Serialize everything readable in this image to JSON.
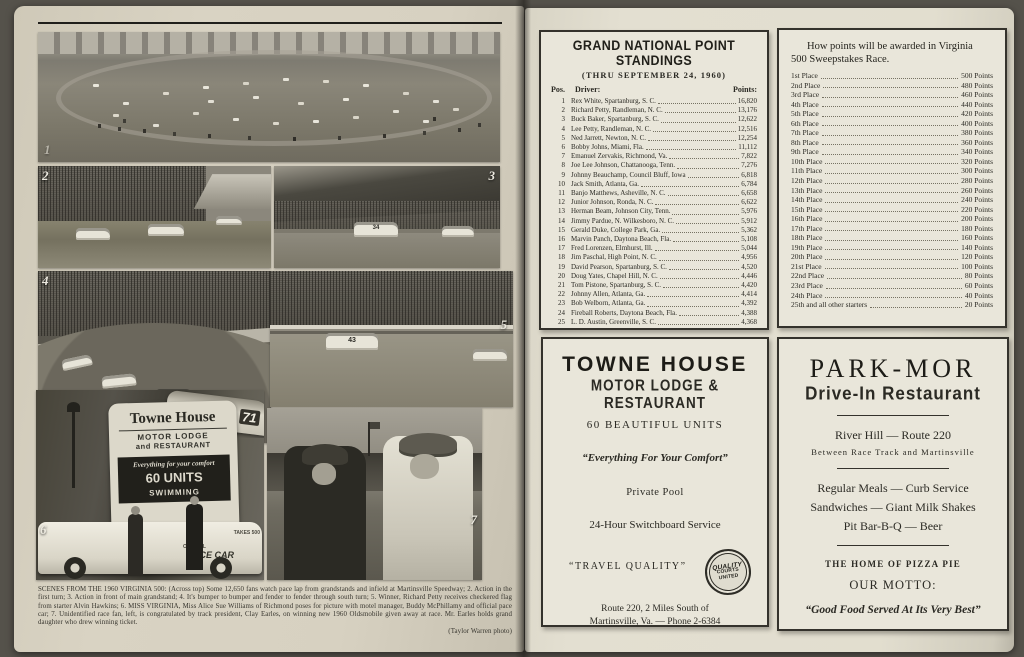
{
  "left": {
    "photo_labels": [
      "1",
      "2",
      "3",
      "4",
      "5",
      "6",
      "7"
    ],
    "photos": {
      "p1_desc": "Some 12,650 fans watch pace lap from grandstands and infield",
      "p2_desc": "Action in the first turn",
      "p3_desc": "Action in front of main grandstand",
      "p4_desc": "Bumper to bumper and fender to fender through south turn",
      "p5_desc": "Winner Richard Petty receives checkered flag",
      "p6_desc": "Miss Virginia with motel manager and official pace car",
      "p7_desc": "Race fan congratulated by track president Clay Earles",
      "p3_car_number": "34",
      "p4_car_number": "71",
      "p5_car_number": "43"
    },
    "sign": {
      "name": "Towne House",
      "line2": "MOTOR LODGE",
      "line3": "and RESTAURANT",
      "panel_script": "Everything for your comfort",
      "panel_units": "60 UNITS",
      "panel_swim": "SWIMMING",
      "car_official": "OFFICIAL",
      "car_door": "PACE CAR",
      "car_trunk": "TAKES 500"
    },
    "caption": {
      "text": "SCENES FROM THE 1960 VIRGINIA 500:  (Across top) Some 12,650 fans watch pace lap from grandstands and infield at Martinsville Speedway; 2. Action in the first turn; 3. Action in front of main grandstand; 4. It's bumper to bumper and fender to fender through south turn; 5. Winner, Richard Petty receives checkered flag from starter Alvin Hawkins; 6. MISS VIRGINIA, Miss Alice Sue Williams of Richmond poses for picture with motel manager, Buddy McPhillamy and official pace car; 7. Unidentified race fan, left, is congratulated by track president, Clay Earles, on winning new 1960 Oldsmobile given away at race. Mr. Earles holds grand daughter who drew winning ticket.",
      "credit": "(Taylor Warren photo)"
    }
  },
  "right": {
    "standings": {
      "title": "GRAND NATIONAL POINT STANDINGS",
      "subtitle": "(THRU SEPTEMBER 24, 1960)",
      "header": {
        "pos": "Pos.",
        "driver": "Driver:",
        "points": "Points:"
      },
      "rows": [
        {
          "pos": "1",
          "driver": "Rex White, Spartanburg, S. C.",
          "points": "16,820"
        },
        {
          "pos": "2",
          "driver": "Richard Petty, Randleman, N. C.",
          "points": "13,176"
        },
        {
          "pos": "3",
          "driver": "Buck Baker, Spartanburg, S. C.",
          "points": "12,622"
        },
        {
          "pos": "4",
          "driver": "Lee Petty, Randleman, N. C.",
          "points": "12,516"
        },
        {
          "pos": "5",
          "driver": "Ned Jarrett, Newton, N. C.",
          "points": "12,254"
        },
        {
          "pos": "6",
          "driver": "Bobby Johns, Miami, Fla.",
          "points": "11,112"
        },
        {
          "pos": "7",
          "driver": "Emanuel Zervakis, Richmond, Va.",
          "points": "7,822"
        },
        {
          "pos": "8",
          "driver": "Joe Lee Johnson, Chattanooga, Tenn.",
          "points": "7,276"
        },
        {
          "pos": "9",
          "driver": "Johnny Beauchamp, Council Bluff, Iowa",
          "points": "6,818"
        },
        {
          "pos": "10",
          "driver": "Jack Smith, Atlanta, Ga.",
          "points": "6,784"
        },
        {
          "pos": "11",
          "driver": "Banjo Matthews, Asheville, N. C.",
          "points": "6,658"
        },
        {
          "pos": "12",
          "driver": "Junior Johnson, Ronda, N. C.",
          "points": "6,622"
        },
        {
          "pos": "13",
          "driver": "Herman Beam, Johnson City, Tenn.",
          "points": "5,976"
        },
        {
          "pos": "14",
          "driver": "Jimmy Pardue, N. Wilkesboro, N. C.",
          "points": "5,912"
        },
        {
          "pos": "15",
          "driver": "Gerald Duke, College Park, Ga.",
          "points": "5,362"
        },
        {
          "pos": "16",
          "driver": "Marvin Panch, Daytona Beach, Fla.",
          "points": "5,108"
        },
        {
          "pos": "17",
          "driver": "Fred Lorenzen, Elmhurst, Ill.",
          "points": "5,044"
        },
        {
          "pos": "18",
          "driver": "Jim Paschal, High Point, N. C.",
          "points": "4,956"
        },
        {
          "pos": "19",
          "driver": "David Pearson, Spartanburg, S. C.",
          "points": "4,520"
        },
        {
          "pos": "20",
          "driver": "Doug Yates, Chapel Hill, N. C.",
          "points": "4,446"
        },
        {
          "pos": "21",
          "driver": "Tom Pistone, Spartanburg, S. C.",
          "points": "4,420"
        },
        {
          "pos": "22",
          "driver": "Johnny Allen, Atlanta, Ga.",
          "points": "4,414"
        },
        {
          "pos": "23",
          "driver": "Bob Welborn, Atlanta, Ga.",
          "points": "4,392"
        },
        {
          "pos": "24",
          "driver": "Fireball Roberts, Daytona Beach, Fla.",
          "points": "4,388"
        },
        {
          "pos": "25",
          "driver": "L. D. Austin, Greenville, S. C.",
          "points": "4,368"
        }
      ]
    },
    "points_award": {
      "title_line1": "How points will be awarded in Virginia",
      "title_line2": "500 Sweepstakes Race.",
      "rows": [
        {
          "place": "1st Place",
          "points": "500 Points"
        },
        {
          "place": "2nd Place",
          "points": "480 Points"
        },
        {
          "place": "3rd Place",
          "points": "460 Points"
        },
        {
          "place": "4th Place",
          "points": "440 Points"
        },
        {
          "place": "5th Place",
          "points": "420 Points"
        },
        {
          "place": "6th Place",
          "points": "400 Points"
        },
        {
          "place": "7th Place",
          "points": "380 Points"
        },
        {
          "place": "8th Place",
          "points": "360 Points"
        },
        {
          "place": "9th Place",
          "points": "340 Points"
        },
        {
          "place": "10th Place",
          "points": "320 Points"
        },
        {
          "place": "11th Place",
          "points": "300 Points"
        },
        {
          "place": "12th Place",
          "points": "280 Points"
        },
        {
          "place": "13th Place",
          "points": "260 Points"
        },
        {
          "place": "14th Place",
          "points": "240 Points"
        },
        {
          "place": "15th Place",
          "points": "220 Points"
        },
        {
          "place": "16th Place",
          "points": "200 Points"
        },
        {
          "place": "17th Place",
          "points": "180 Points"
        },
        {
          "place": "18th Place",
          "points": "160 Points"
        },
        {
          "place": "19th Place",
          "points": "140 Points"
        },
        {
          "place": "20th Place",
          "points": "120 Points"
        },
        {
          "place": "21st Place",
          "points": "100 Points"
        },
        {
          "place": "22nd Place",
          "points": "80 Points"
        },
        {
          "place": "23rd Place",
          "points": "60 Points"
        },
        {
          "place": "24th Place",
          "points": "40 Points"
        },
        {
          "place": "25th and all other starters",
          "points": "20 Points"
        }
      ]
    },
    "towne_ad": {
      "name": "TOWNE HOUSE",
      "subtitle": "MOTOR LODGE & RESTAURANT",
      "units": "60 BEAUTIFUL UNITS",
      "slogan": "“Everything For Your Comfort”",
      "pool": "Private Pool",
      "switchboard": "24-Hour Switchboard Service",
      "travel": "“TRAVEL QUALITY”",
      "seal": {
        "line1": "QUALITY",
        "line2": "COURTS",
        "line3": "UNITED"
      },
      "address1": "Route 220, 2 Miles South of",
      "address2": "Martinsville, Va. — Phone 2-6384"
    },
    "parkmor_ad": {
      "name": "PARK-MOR",
      "type": "Drive-In  Restaurant",
      "loc1": "River Hill — Route 220",
      "loc2": "Between Race Track and Martinsville",
      "meal1": "Regular Meals — Curb Service",
      "meal2": "Sandwiches — Giant Milk Shakes",
      "meal3": "Pit Bar-B-Q — Beer",
      "pizza": "THE HOME OF PIZZA PIE",
      "motto_label": "OUR MOTTO:",
      "motto": "“Good Food Served At Its Very Best”"
    }
  }
}
